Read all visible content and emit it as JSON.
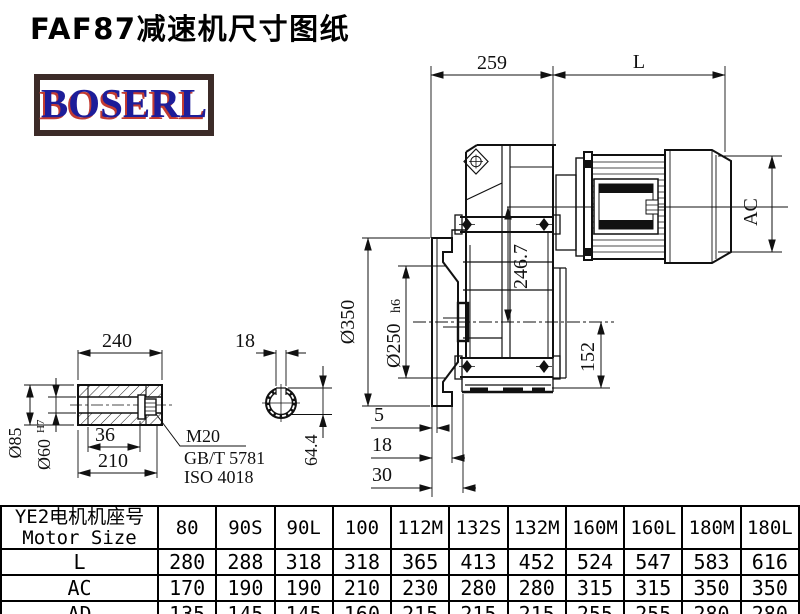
{
  "header": {
    "title": "FAF87减速机尺寸图纸",
    "logo_text": "BOSERL"
  },
  "drawing": {
    "main_view": {
      "dim_259": "259",
      "dim_L": "L",
      "dim_AC": "AC",
      "dim_350": "Ø350",
      "dim_250": "Ø250",
      "dim_250_tol": "h6",
      "dim_246_7": "246.7",
      "dim_152": "152",
      "dim_5": "5",
      "dim_18": "18",
      "dim_30": "30"
    },
    "shaft_view": {
      "dim_240": "240",
      "dim_85": "Ø85",
      "dim_60": "Ø60",
      "dim_60_tol": "H7",
      "dim_36": "36",
      "dim_210": "210",
      "bolt_label": "M20",
      "bolt_std_gb": "GB/T 5781",
      "bolt_std_iso": "ISO 4018",
      "dim_key_18": "18",
      "dim_64_4": "64.4"
    }
  },
  "table": {
    "header_cn": "YE2电机机座号",
    "header_en": "Motor Size",
    "columns": [
      "80",
      "90S",
      "90L",
      "100",
      "112M",
      "132S",
      "132M",
      "160M",
      "160L",
      "180M",
      "180L"
    ],
    "rows": [
      {
        "label": "L",
        "values": [
          "280",
          "288",
          "318",
          "318",
          "365",
          "413",
          "452",
          "524",
          "547",
          "583",
          "616"
        ]
      },
      {
        "label": "AC",
        "values": [
          "170",
          "190",
          "190",
          "210",
          "230",
          "280",
          "280",
          "315",
          "315",
          "350",
          "350"
        ]
      },
      {
        "label": "AD",
        "values": [
          "135",
          "145",
          "145",
          "160",
          "215",
          "215",
          "215",
          "255",
          "255",
          "280",
          "280"
        ]
      }
    ]
  }
}
